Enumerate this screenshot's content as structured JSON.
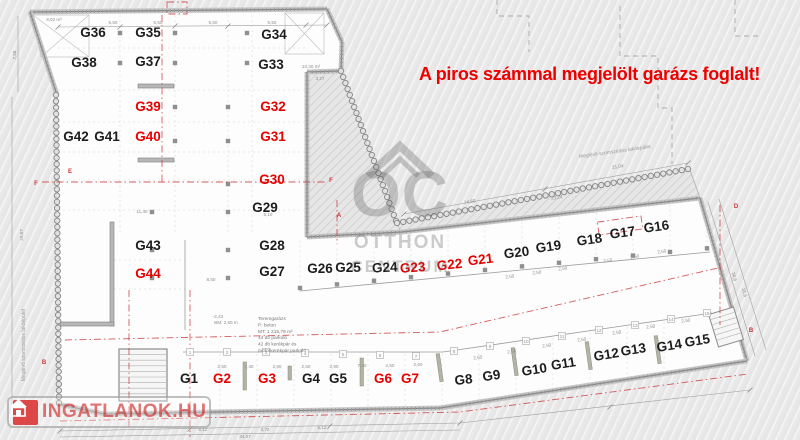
{
  "warning": {
    "text": "A piros számmal megjelölt garázs foglalt!"
  },
  "watermark": {
    "monogram": "OC",
    "line1": "OTTHON",
    "line2": "CENTRUM"
  },
  "logo": {
    "text": "INGATLANOK.HU"
  },
  "neighbor_labels": {
    "left": "Meglévő szomszédos lakóépület",
    "top_right": "Meglévő szomszédos lakóépület"
  },
  "info_block": {
    "lines": [
      "Teremgarázs",
      "P:      beton",
      "MT: 1 215,78 m²",
      "44 db parkoló",
      "42 db kerékpár és",
      "motorkerékpár parkoló"
    ]
  },
  "colors": {
    "occupied": "#e60000",
    "free": "#1c1c1c",
    "warning": "#ee0000",
    "section_line": "#cc3333"
  },
  "legend_meaning": {
    "occupied_color": "piros = foglalt"
  },
  "spots": [
    {
      "id": "G1",
      "x": 189,
      "y": 383,
      "s": "free",
      "r": 0
    },
    {
      "id": "G2",
      "x": 222,
      "y": 383,
      "s": "taken",
      "r": 0
    },
    {
      "id": "G3",
      "x": 267,
      "y": 383,
      "s": "taken",
      "r": 0
    },
    {
      "id": "G4",
      "x": 311,
      "y": 383,
      "s": "free",
      "r": 0
    },
    {
      "id": "G5",
      "x": 338,
      "y": 383,
      "s": "free",
      "r": 0
    },
    {
      "id": "G6",
      "x": 383,
      "y": 383,
      "s": "taken",
      "r": 0
    },
    {
      "id": "G7",
      "x": 410,
      "y": 383,
      "s": "taken",
      "r": 0
    },
    {
      "id": "G8",
      "x": 464,
      "y": 384,
      "s": "free",
      "r": -6
    },
    {
      "id": "G9",
      "x": 492,
      "y": 380,
      "s": "free",
      "r": -8
    },
    {
      "id": "G10",
      "x": 535,
      "y": 374,
      "s": "free",
      "r": -9
    },
    {
      "id": "G11",
      "x": 564,
      "y": 368,
      "s": "free",
      "r": -9
    },
    {
      "id": "G12",
      "x": 607,
      "y": 359,
      "s": "free",
      "r": -9
    },
    {
      "id": "G13",
      "x": 634,
      "y": 354,
      "s": "free",
      "r": -9
    },
    {
      "id": "G14",
      "x": 670,
      "y": 350,
      "s": "free",
      "r": -9
    },
    {
      "id": "G15",
      "x": 698,
      "y": 345,
      "s": "free",
      "r": -9
    },
    {
      "id": "G16",
      "x": 657,
      "y": 231,
      "s": "free",
      "r": -8
    },
    {
      "id": "G17",
      "x": 623,
      "y": 237,
      "s": "free",
      "r": -8
    },
    {
      "id": "G18",
      "x": 590,
      "y": 244,
      "s": "free",
      "r": -8
    },
    {
      "id": "G19",
      "x": 549,
      "y": 251,
      "s": "free",
      "r": -8
    },
    {
      "id": "G20",
      "x": 517,
      "y": 257,
      "s": "free",
      "r": -7
    },
    {
      "id": "G21",
      "x": 481,
      "y": 264,
      "s": "taken",
      "r": -7
    },
    {
      "id": "G22",
      "x": 450,
      "y": 269,
      "s": "taken",
      "r": -6
    },
    {
      "id": "G23",
      "x": 413,
      "y": 272,
      "s": "taken",
      "r": -4
    },
    {
      "id": "G24",
      "x": 385,
      "y": 272,
      "s": "free",
      "r": -3
    },
    {
      "id": "G25",
      "x": 348,
      "y": 272,
      "s": "free",
      "r": 0
    },
    {
      "id": "G26",
      "x": 320,
      "y": 273,
      "s": "free",
      "r": 0
    },
    {
      "id": "G27",
      "x": 272,
      "y": 276,
      "s": "free",
      "r": 0
    },
    {
      "id": "G28",
      "x": 272,
      "y": 250,
      "s": "free",
      "r": 0
    },
    {
      "id": "G29",
      "x": 265,
      "y": 212,
      "s": "free",
      "r": 0
    },
    {
      "id": "G30",
      "x": 272,
      "y": 184,
      "s": "taken",
      "r": 0
    },
    {
      "id": "G31",
      "x": 273,
      "y": 141,
      "s": "taken",
      "r": 0
    },
    {
      "id": "G32",
      "x": 273,
      "y": 111,
      "s": "taken",
      "r": 0
    },
    {
      "id": "G33",
      "x": 271,
      "y": 69,
      "s": "free",
      "r": 0
    },
    {
      "id": "G34",
      "x": 274,
      "y": 39,
      "s": "free",
      "r": 0
    },
    {
      "id": "G35",
      "x": 148,
      "y": 37,
      "s": "free",
      "r": 0
    },
    {
      "id": "G36",
      "x": 93,
      "y": 37,
      "s": "free",
      "r": 0
    },
    {
      "id": "G37",
      "x": 148,
      "y": 66,
      "s": "free",
      "r": 0
    },
    {
      "id": "G38",
      "x": 84,
      "y": 67,
      "s": "free",
      "r": 0
    },
    {
      "id": "G39",
      "x": 148,
      "y": 111,
      "s": "taken",
      "r": 0
    },
    {
      "id": "G40",
      "x": 148,
      "y": 141,
      "s": "taken",
      "r": 0
    },
    {
      "id": "G41",
      "x": 107,
      "y": 141,
      "s": "free",
      "r": 0
    },
    {
      "id": "G42",
      "x": 76,
      "y": 141,
      "s": "free",
      "r": 0
    },
    {
      "id": "G43",
      "x": 148,
      "y": 250,
      "s": "free",
      "r": 0
    },
    {
      "id": "G44",
      "x": 148,
      "y": 278,
      "s": "taken",
      "r": 0
    }
  ],
  "dimensions": [
    {
      "t": "5,50",
      "x": 113,
      "y": 24,
      "r": 0
    },
    {
      "t": "5,50",
      "x": 158,
      "y": 24,
      "r": 0
    },
    {
      "t": "5,50",
      "x": 213,
      "y": 24,
      "r": 0
    },
    {
      "t": "5,50",
      "x": 272,
      "y": 24,
      "r": 0
    },
    {
      "t": "7,58",
      "x": 16,
      "y": 55,
      "r": -90
    },
    {
      "t": "24,07",
      "x": 23,
      "y": 235,
      "r": -90
    },
    {
      "t": "9,02 m²",
      "x": 54,
      "y": 21,
      "r": 0
    },
    {
      "t": "10,30 m²",
      "x": 311,
      "y": 68,
      "r": 0
    },
    {
      "t": "3,27",
      "x": 320,
      "y": 80,
      "r": 0
    },
    {
      "t": "11,40",
      "x": 142,
      "y": 213,
      "r": 0
    },
    {
      "t": "5,10",
      "x": 268,
      "y": 216,
      "r": 0
    },
    {
      "t": "8,50",
      "x": 211,
      "y": 281,
      "r": 0
    },
    {
      "t": "14,60",
      "x": 470,
      "y": 203,
      "r": -8
    },
    {
      "t": "23,24",
      "x": 557,
      "y": 199,
      "r": -8
    },
    {
      "t": "21,04",
      "x": 618,
      "y": 168,
      "r": -9
    },
    {
      "t": "2,50",
      "x": 222,
      "y": 368,
      "r": 0
    },
    {
      "t": "7,40",
      "x": 249,
      "y": 368,
      "r": 0
    },
    {
      "t": "2,60",
      "x": 277,
      "y": 368,
      "r": 0
    },
    {
      "t": "2,50",
      "x": 306,
      "y": 368,
      "r": 0
    },
    {
      "t": "2,90",
      "x": 334,
      "y": 368,
      "r": 0
    },
    {
      "t": "7,40",
      "x": 362,
      "y": 367,
      "r": 0
    },
    {
      "t": "2,50",
      "x": 390,
      "y": 367,
      "r": 0
    },
    {
      "t": "2,50",
      "x": 418,
      "y": 366,
      "r": 0
    },
    {
      "t": "2,50",
      "x": 478,
      "y": 359,
      "r": -8
    },
    {
      "t": "2,50",
      "x": 512,
      "y": 353,
      "r": -8
    },
    {
      "t": "2,50",
      "x": 547,
      "y": 347,
      "r": -8
    },
    {
      "t": "2,50",
      "x": 582,
      "y": 341,
      "r": -8
    },
    {
      "t": "2,50",
      "x": 617,
      "y": 334,
      "r": -8
    },
    {
      "t": "2,50",
      "x": 651,
      "y": 328,
      "r": -8
    },
    {
      "t": "2,50",
      "x": 686,
      "y": 322,
      "r": -8
    },
    {
      "t": "2,50",
      "x": 510,
      "y": 278,
      "r": -7
    },
    {
      "t": "2,50",
      "x": 537,
      "y": 274,
      "r": -7
    },
    {
      "t": "2,50",
      "x": 563,
      "y": 270,
      "r": -7
    },
    {
      "t": "2,50",
      "x": 608,
      "y": 262,
      "r": -7
    },
    {
      "t": "2,50",
      "x": 635,
      "y": 258,
      "r": -7
    },
    {
      "t": "2,50",
      "x": 662,
      "y": 253,
      "r": -7
    },
    {
      "t": "6,12",
      "x": 203,
      "y": 431,
      "r": 0
    },
    {
      "t": "3,72",
      "x": 265,
      "y": 431,
      "r": 0
    },
    {
      "t": "5,12",
      "x": 322,
      "y": 429,
      "r": 0
    },
    {
      "t": "34,07",
      "x": 245,
      "y": 438,
      "r": 0
    },
    {
      "t": "34,5",
      "x": 733,
      "y": 277,
      "r": 73
    },
    {
      "t": "31,5",
      "x": 743,
      "y": 293,
      "r": 73
    },
    {
      "t": "-2,43",
      "x": 218,
      "y": 318,
      "r": 0
    },
    {
      "t": "BM: 2,65 m",
      "x": 226,
      "y": 324,
      "r": 0
    }
  ],
  "section_markers": [
    {
      "t": "F",
      "x": 36,
      "y": 185
    },
    {
      "t": "F",
      "x": 331,
      "y": 182
    },
    {
      "t": "E",
      "x": 70,
      "y": 173
    },
    {
      "t": "A",
      "x": 339,
      "y": 217
    },
    {
      "t": "D",
      "x": 736,
      "y": 208
    },
    {
      "t": "B",
      "x": 751,
      "y": 332
    },
    {
      "t": "B",
      "x": 44,
      "y": 364
    }
  ],
  "grid_bubbles": [
    {
      "n": "1",
      "x": 190,
      "y": 352
    },
    {
      "n": "2",
      "x": 227,
      "y": 352
    },
    {
      "n": "3",
      "x": 266,
      "y": 352
    },
    {
      "n": "4",
      "x": 305,
      "y": 353
    },
    {
      "n": "5",
      "x": 343,
      "y": 354
    },
    {
      "n": "6",
      "x": 380,
      "y": 355
    },
    {
      "n": "7",
      "x": 416,
      "y": 356
    },
    {
      "n": "8",
      "x": 454,
      "y": 351
    },
    {
      "n": "9",
      "x": 490,
      "y": 346
    },
    {
      "n": "10",
      "x": 526,
      "y": 341
    },
    {
      "n": "11",
      "x": 562,
      "y": 336
    },
    {
      "n": "12",
      "x": 599,
      "y": 330
    },
    {
      "n": "13",
      "x": 635,
      "y": 325
    },
    {
      "n": "14",
      "x": 671,
      "y": 319
    },
    {
      "n": "15",
      "x": 707,
      "y": 313
    }
  ]
}
